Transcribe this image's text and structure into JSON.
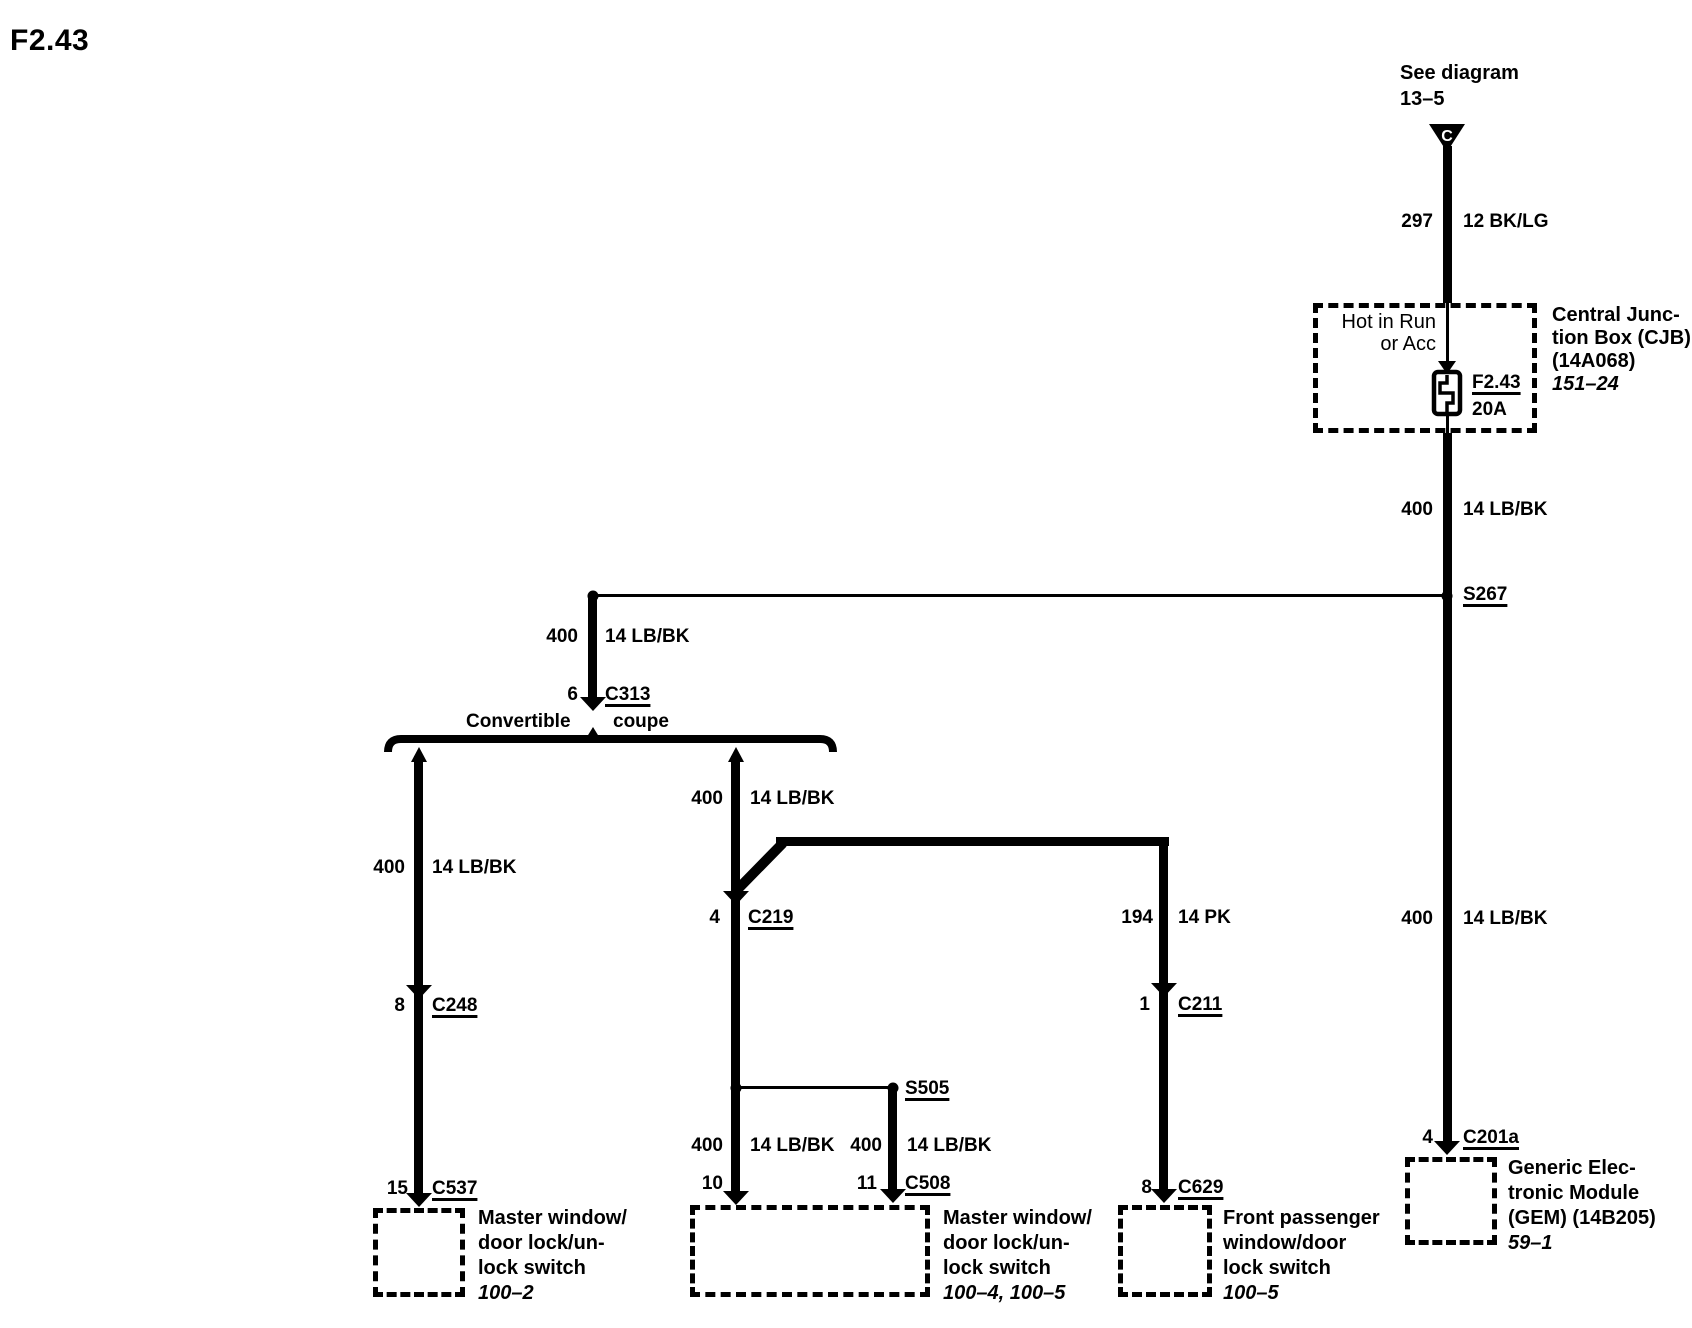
{
  "title": "F2.43",
  "source_note": {
    "line1": "See diagram",
    "line2": "13–5",
    "connector_letter": "C"
  },
  "cjb": {
    "hot_line1": "Hot in Run",
    "hot_line2": "or Acc",
    "fuse_name": "F2.43",
    "fuse_rating": "20A",
    "name_line1": "Central Junc-",
    "name_line2": "tion Box (CJB)",
    "name_line3": "(14A068)",
    "page_ref": "151–24"
  },
  "splices": {
    "s267": "S267",
    "s505": "S505"
  },
  "split": {
    "left": "Convertible",
    "right": "coupe"
  },
  "circuits": {
    "feed": {
      "number": "297",
      "spec": "12 BK/LG"
    },
    "cjb_out": {
      "number": "400",
      "spec": "14 LB/BK"
    },
    "to_c313": {
      "number": "400",
      "spec": "14 LB/BK"
    },
    "convertible": {
      "number": "400",
      "spec": "14 LB/BK"
    },
    "coupe": {
      "number": "400",
      "spec": "14 LB/BK"
    },
    "s505_left": {
      "number": "400",
      "spec": "14 LB/BK"
    },
    "s505_right": {
      "number": "400",
      "spec": "14 LB/BK"
    },
    "passenger": {
      "number": "194",
      "spec": "14 PK"
    },
    "to_gem": {
      "number": "400",
      "spec": "14 LB/BK"
    }
  },
  "connectors": {
    "c313": {
      "pin": "6",
      "name": "C313"
    },
    "c248": {
      "pin": "8",
      "name": "C248"
    },
    "c537": {
      "pin": "15",
      "name": "C537"
    },
    "c219": {
      "pin": "4",
      "name": "C219"
    },
    "c508_left_pin": "10",
    "c508": {
      "pin": "11",
      "name": "C508"
    },
    "c211": {
      "pin": "1",
      "name": "C211"
    },
    "c629": {
      "pin": "8",
      "name": "C629"
    },
    "c201a": {
      "pin": "4",
      "name": "C201a"
    }
  },
  "components": {
    "master_convertible": {
      "line1": "Master window/",
      "line2": "door lock/un-",
      "line3": "lock switch",
      "page_ref": "100–2"
    },
    "master_coupe": {
      "line1": "Master window/",
      "line2": "door lock/un-",
      "line3": "lock switch",
      "page_ref": "100–4, 100–5"
    },
    "front_passenger": {
      "line1": "Front passenger",
      "line2": "window/door",
      "line3": "lock switch",
      "page_ref": "100–5"
    },
    "gem": {
      "line1": "Generic Elec-",
      "line2": "tronic Module",
      "line3": "(GEM) (14B205)",
      "page_ref": "59–1"
    }
  }
}
